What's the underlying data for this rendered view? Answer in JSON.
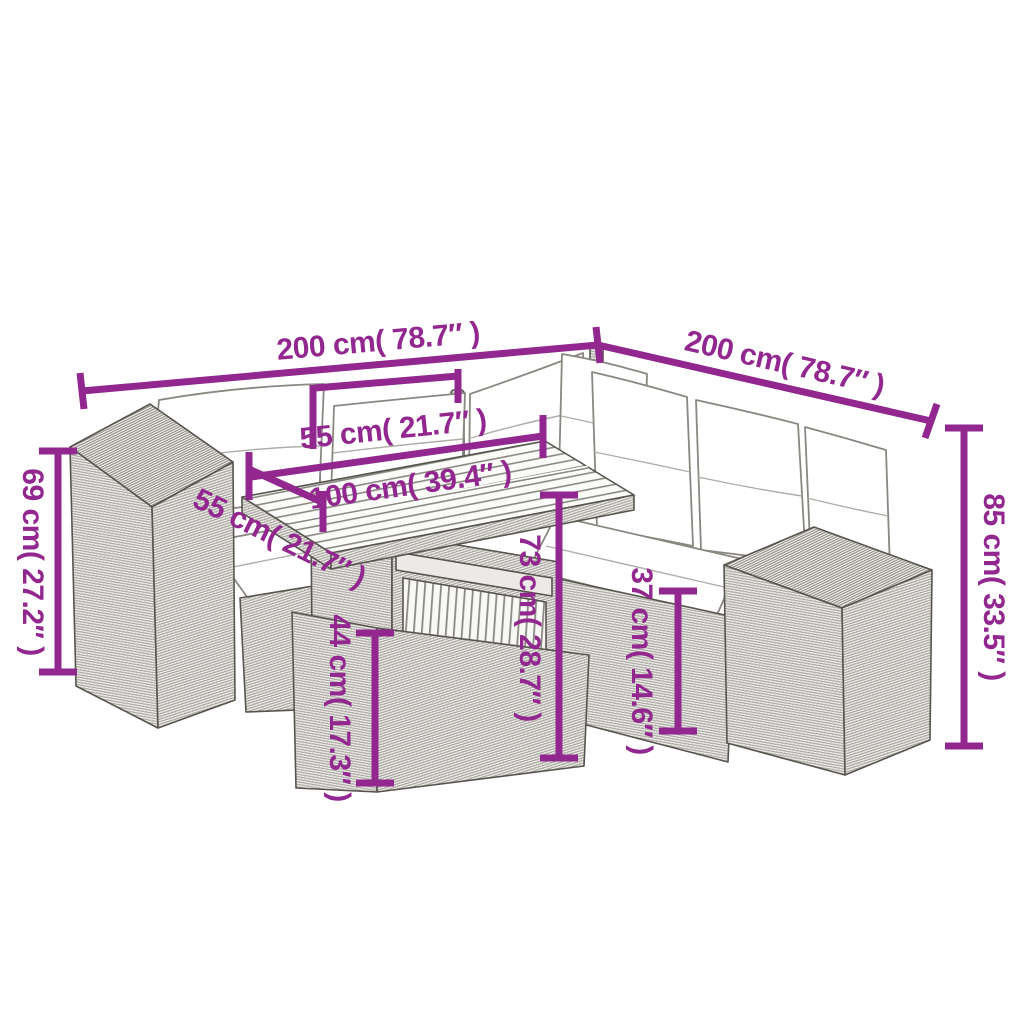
{
  "colors": {
    "dimension_accent": "#92278F",
    "drawing_outline": "#57544e",
    "background": "#ffffff"
  },
  "diagram": {
    "dimensions": {
      "sofa_left_width": {
        "label": "200 cm( 78.7″ )"
      },
      "sofa_right_width": {
        "label": "200 cm( 78.7″ )"
      },
      "backrest_width": {
        "label": "55 cm( 21.7″ )"
      },
      "table_length": {
        "label": "100 cm( 39.4″ )"
      },
      "table_depth": {
        "label": "55 cm( 21.7″ )"
      },
      "armrest_height": {
        "label": "69 cm( 27.2″ )"
      },
      "total_height": {
        "label": "85 cm( 33.5″ )"
      },
      "table_height": {
        "label": "73 cm( 28.7″ )"
      },
      "table_base_height": {
        "label": "44 cm( 17.3″ )"
      },
      "seat_height": {
        "label": "37 cm( 14.6″ )"
      }
    }
  }
}
